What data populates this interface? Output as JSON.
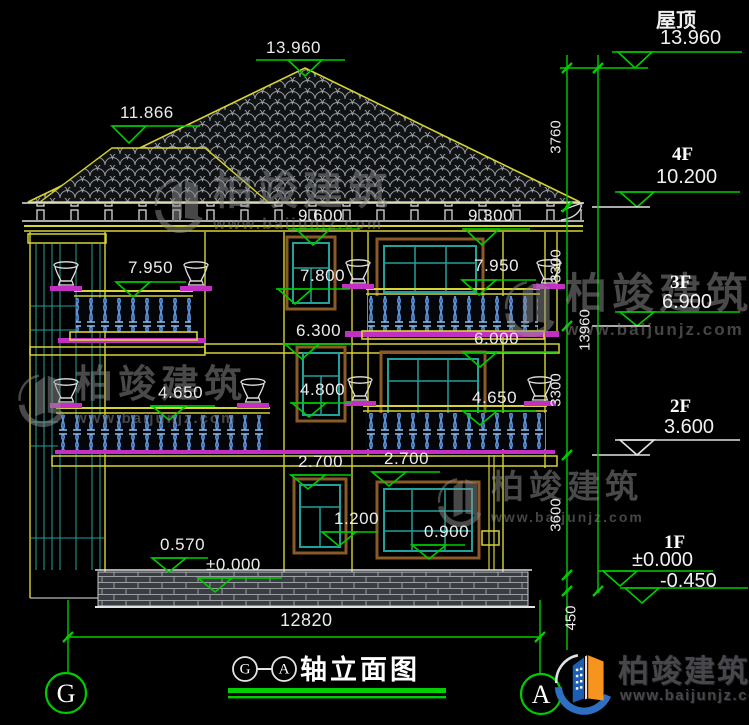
{
  "marks": [
    {
      "v": "13.960"
    },
    {
      "v": "11.866"
    },
    {
      "v": "9.600"
    },
    {
      "v": "9.300"
    },
    {
      "v": "7.950"
    },
    {
      "v": "7.800"
    },
    {
      "v": "7.950"
    },
    {
      "v": "6.300"
    },
    {
      "v": "6.000"
    },
    {
      "v": "4.650"
    },
    {
      "v": "4.800"
    },
    {
      "v": "4.650"
    },
    {
      "v": "2.700"
    },
    {
      "v": "2.700"
    },
    {
      "v": "1.200"
    },
    {
      "v": "0.900"
    },
    {
      "v": "0.570"
    },
    {
      "v": "±0.000"
    }
  ],
  "right_panel": {
    "levels": [
      {
        "name": "屋顶",
        "elev": "13.960"
      },
      {
        "name": "4F",
        "elev": "10.200"
      },
      {
        "name": "3F",
        "elev": "6.900"
      },
      {
        "name": "2F",
        "elev": "3.600"
      },
      {
        "name": "1F",
        "elev": "±0.000",
        "elev_below": "-0.450"
      }
    ],
    "chain": [
      "3760",
      "3300",
      "3300",
      "3600",
      "450"
    ],
    "total": "13960"
  },
  "bottom": {
    "overall_dim": "12820",
    "axis_left": "G",
    "axis_right": "A",
    "title_dash": "—",
    "title": "轴立面图"
  },
  "brand": {
    "name": "柏竣建筑",
    "site": "www.baijunjz.com"
  },
  "colors": {
    "line_yellow": "#d6d335",
    "line_green": "#00cc00",
    "line_white": "#e3e3e3",
    "line_cyan": "#22a09a",
    "line_magenta": "#cc2fcc",
    "line_brown": "#8a5a28",
    "baluster_blue": "#5b93dd",
    "tile_gray": "#9aa0a6",
    "background": "#000000"
  }
}
